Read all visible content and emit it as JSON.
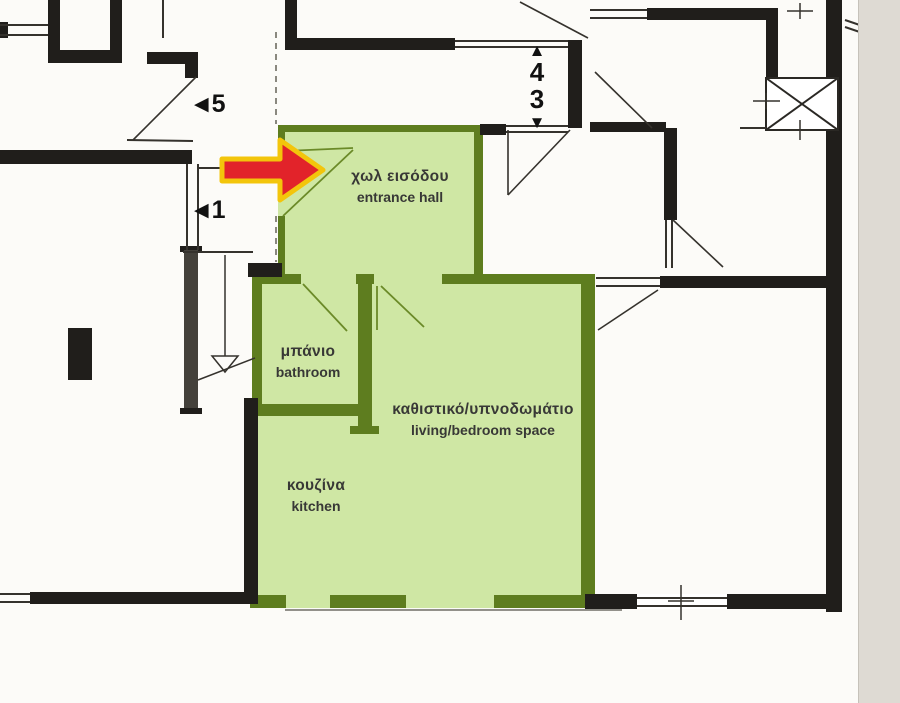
{
  "floor_plan": {
    "type": "apartment floor plan (scanned architectural drawing)",
    "rooms": [
      {
        "id": "entrance-hall",
        "greek": "χωλ εισόδου",
        "english": "entrance hall"
      },
      {
        "id": "bathroom",
        "greek": "μπάνιο",
        "english": "bathroom"
      },
      {
        "id": "living-bedroom",
        "greek": "καθιστικό/υπνοδωμάτιο",
        "english": "living/bedroom space"
      },
      {
        "id": "kitchen",
        "greek": "κουζίνα",
        "english": "kitchen"
      }
    ],
    "unit_markers": [
      {
        "id": "unit-5",
        "label": "5",
        "arrow_glyph": "◀",
        "direction": "left"
      },
      {
        "id": "unit-1",
        "label": "1",
        "arrow_glyph": "◀",
        "direction": "left"
      },
      {
        "id": "unit-4",
        "label": "4",
        "arrow_glyph": "▲",
        "direction": "up"
      },
      {
        "id": "unit-3",
        "label": "3",
        "arrow_glyph": "▼",
        "direction": "down"
      }
    ],
    "annotations": {
      "highlight_arrow": "red arrow with yellow outline pointing at the entrance door of the highlighted flat"
    },
    "colors": {
      "highlight_fill": "#cfe7a4",
      "highlight_wall": "#5e7d1f",
      "structure_wall": "#201e1b",
      "arrow_fill": "#e2232a",
      "arrow_outline": "#f3c50b",
      "paper": "#fcfbf8",
      "scan_edge": "#dedad3"
    }
  }
}
